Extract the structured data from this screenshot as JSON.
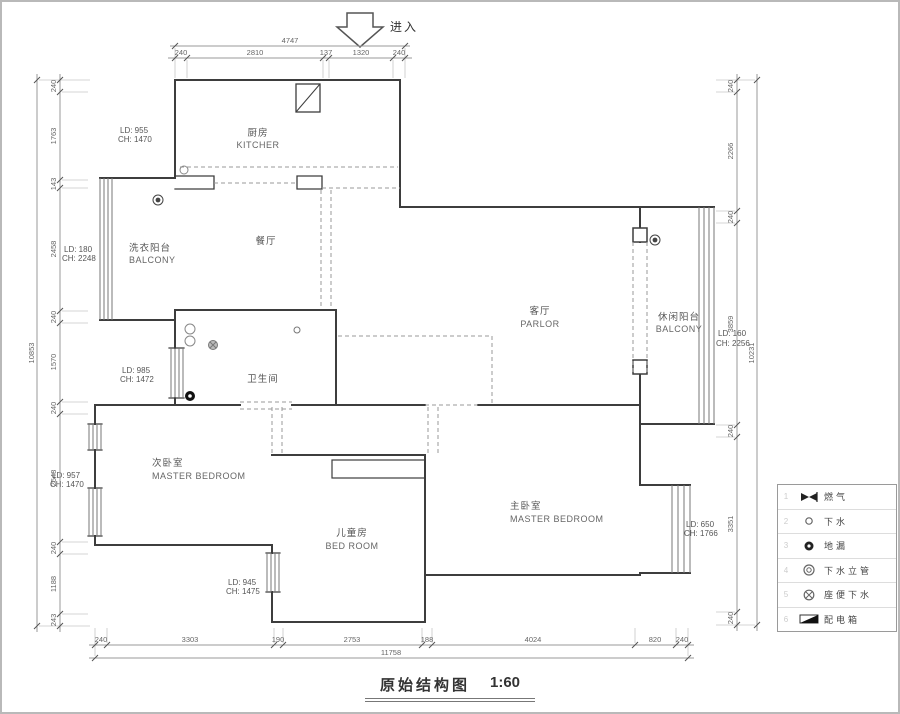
{
  "colors": {
    "wall": "#3d3d3d",
    "window_line": "#777777",
    "dashed_opening": "#999999",
    "dim_line": "#999999",
    "dim_text": "#666666",
    "label_text": "#555555",
    "page_border": "#b9b9b9"
  },
  "entrance": {
    "label": "进入"
  },
  "title": {
    "text": "原始结构图",
    "scale": "1:60"
  },
  "rooms": {
    "kitchen": {
      "zh": "厨房",
      "en": "KITCHER"
    },
    "dining": {
      "zh": "餐厅"
    },
    "laundry_balcony": {
      "zh": "洗衣阳台",
      "en": "BALCONY"
    },
    "bathroom": {
      "zh": "卫生间"
    },
    "parlor": {
      "zh": "客厅",
      "en": "PARLOR"
    },
    "leisure_balcony": {
      "zh": "休闲阳台",
      "en": "BALCONY"
    },
    "second_bedroom": {
      "zh": "次卧室",
      "en": "MASTER BEDROOM"
    },
    "kids_room": {
      "zh": "儿童房",
      "en": "BED ROOM"
    },
    "master_bedroom": {
      "zh": "主卧室",
      "en": "MASTER BEDROOM"
    }
  },
  "annotations": {
    "kitchen": {
      "ld": "LD: 955",
      "ch": "CH: 1470"
    },
    "laundry_balcony": {
      "ld": "LD: 180",
      "ch": "CH: 2248"
    },
    "bathroom": {
      "ld": "LD: 985",
      "ch": "CH: 1472"
    },
    "second_bedroom": {
      "ld": "LD: 957",
      "ch": "CH: 1470"
    },
    "kids_room": {
      "ld": "LD: 945",
      "ch": "CH: 1475"
    },
    "master_bedroom": {
      "ld": "LD: 650",
      "ch": "CH: 1766"
    },
    "leisure_balcony": {
      "ld": "LD: 160",
      "ch": "CH: 2256"
    }
  },
  "dimensions": {
    "top": {
      "total": "4747",
      "segments": [
        "240",
        "2810",
        "137",
        "1320",
        "240"
      ]
    },
    "bottom": {
      "total": "11758",
      "segments": [
        "240",
        "3303",
        "190",
        "2753",
        "188",
        "4024",
        "820",
        "240"
      ]
    },
    "left": {
      "total": "10853",
      "segments": [
        "240",
        "1763",
        "143",
        "2458",
        "240",
        "1570",
        "240",
        "2548",
        "240",
        "1188",
        "243"
      ]
    },
    "right": {
      "total": "10231",
      "segments": [
        "240",
        "2266",
        "240",
        "3859",
        "240",
        "3351",
        "240"
      ]
    }
  },
  "legend": {
    "rows": [
      {
        "num": "1",
        "label": "燃气",
        "symbol": "gas-valve"
      },
      {
        "num": "2",
        "label": "下水",
        "symbol": "drain"
      },
      {
        "num": "3",
        "label": "地漏",
        "symbol": "floor-drain"
      },
      {
        "num": "4",
        "label": "下水立管",
        "symbol": "drain-riser"
      },
      {
        "num": "5",
        "label": "座便下水",
        "symbol": "toilet-drain"
      },
      {
        "num": "6",
        "label": "配电箱",
        "symbol": "distribution-box"
      }
    ]
  }
}
